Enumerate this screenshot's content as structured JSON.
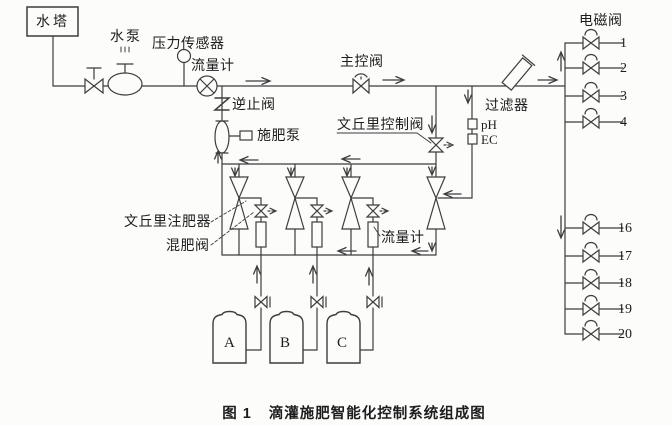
{
  "figure": {
    "caption_prefix": "图 1",
    "caption_title": "滴灌施肥智能化控制系统组成图",
    "labels": {
      "water_tower": "水塔",
      "water_pump": "水泵",
      "pressure_sensor": "压力传感器",
      "flow_meter_main": "流量计",
      "check_valve": "逆止阀",
      "fertilizer_pump": "施肥泵",
      "main_control_valve": "主控阀",
      "solenoid_valve": "电磁阀",
      "filter": "过滤器",
      "venturi_control_valve": "文丘里控制阀",
      "ph": "pH",
      "ec": "EC",
      "venturi_injector": "文丘里注肥器",
      "mixing_valve": "混肥阀",
      "flow_meter_mid": "流量计",
      "tank_a": "A",
      "tank_b": "B",
      "tank_c": "C"
    },
    "valve_numbers_top": [
      "1",
      "2",
      "3",
      "4"
    ],
    "valve_numbers_bottom": [
      "16",
      "17",
      "18",
      "19",
      "20"
    ],
    "colors": {
      "line": "#3d3d3d",
      "background": "#fcfcfb",
      "text": "#1d1d1d"
    }
  }
}
